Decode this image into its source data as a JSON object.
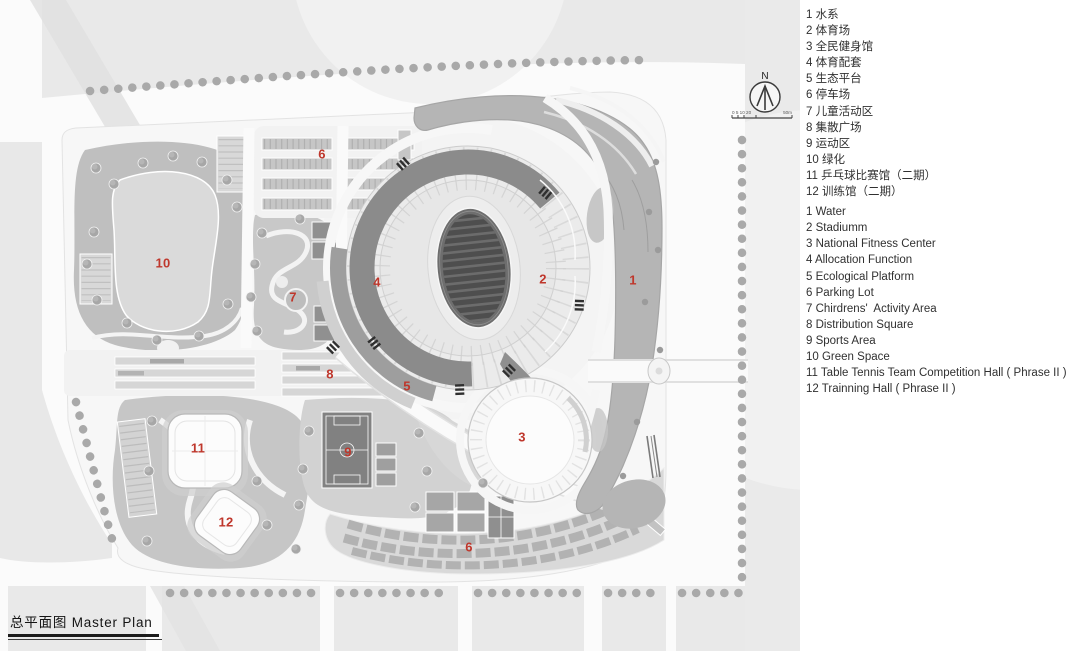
{
  "title": {
    "text": "总平面图 Master  Plan"
  },
  "compass": {
    "north_label": "N",
    "scale_left": "0 5 10 20",
    "scale_right": "50m"
  },
  "colors": {
    "label_red": "#bf372c",
    "river_gray": "#b5b5b5",
    "park_gray": "#bfbfbf"
  },
  "legend": {
    "zh": [
      "1 水系",
      "2 体育场",
      "3 全民健身馆",
      "4 体育配套",
      "5 生态平台",
      "6 停车场",
      "7 儿童活动区",
      "8 集散广场",
      "9 运动区",
      "10 绿化",
      "11 乒乓球比赛馆（二期）",
      "12 训练馆（二期）"
    ],
    "en": [
      "1 Water",
      "2 Stadiumm",
      "3 National Fitness Center",
      "4 Allocation Function",
      "5 Ecological Platform",
      "6 Parking Lot",
      "7 Chirdrens'  Activity Area",
      "8 Distribution Square",
      "9 Sports Area",
      "10 Green Space",
      "11 Table Tennis Team Competition Hall ( Phrase II )",
      "12 Trainning Hall ( Phrase II )"
    ]
  },
  "plan": {
    "labels": [
      {
        "text": "10",
        "x": 163,
        "y": 263
      },
      {
        "text": "6",
        "x": 322,
        "y": 154
      },
      {
        "text": "7",
        "x": 293,
        "y": 297
      },
      {
        "text": "4",
        "x": 377,
        "y": 282
      },
      {
        "text": "2",
        "x": 543,
        "y": 279
      },
      {
        "text": "1",
        "x": 633,
        "y": 280
      },
      {
        "text": "8",
        "x": 330,
        "y": 374
      },
      {
        "text": "5",
        "x": 407,
        "y": 386
      },
      {
        "text": "9",
        "x": 348,
        "y": 452
      },
      {
        "text": "3",
        "x": 522,
        "y": 437
      },
      {
        "text": "11",
        "x": 198,
        "y": 448
      },
      {
        "text": "12",
        "x": 226,
        "y": 522
      },
      {
        "text": "6",
        "x": 469,
        "y": 547
      }
    ]
  }
}
